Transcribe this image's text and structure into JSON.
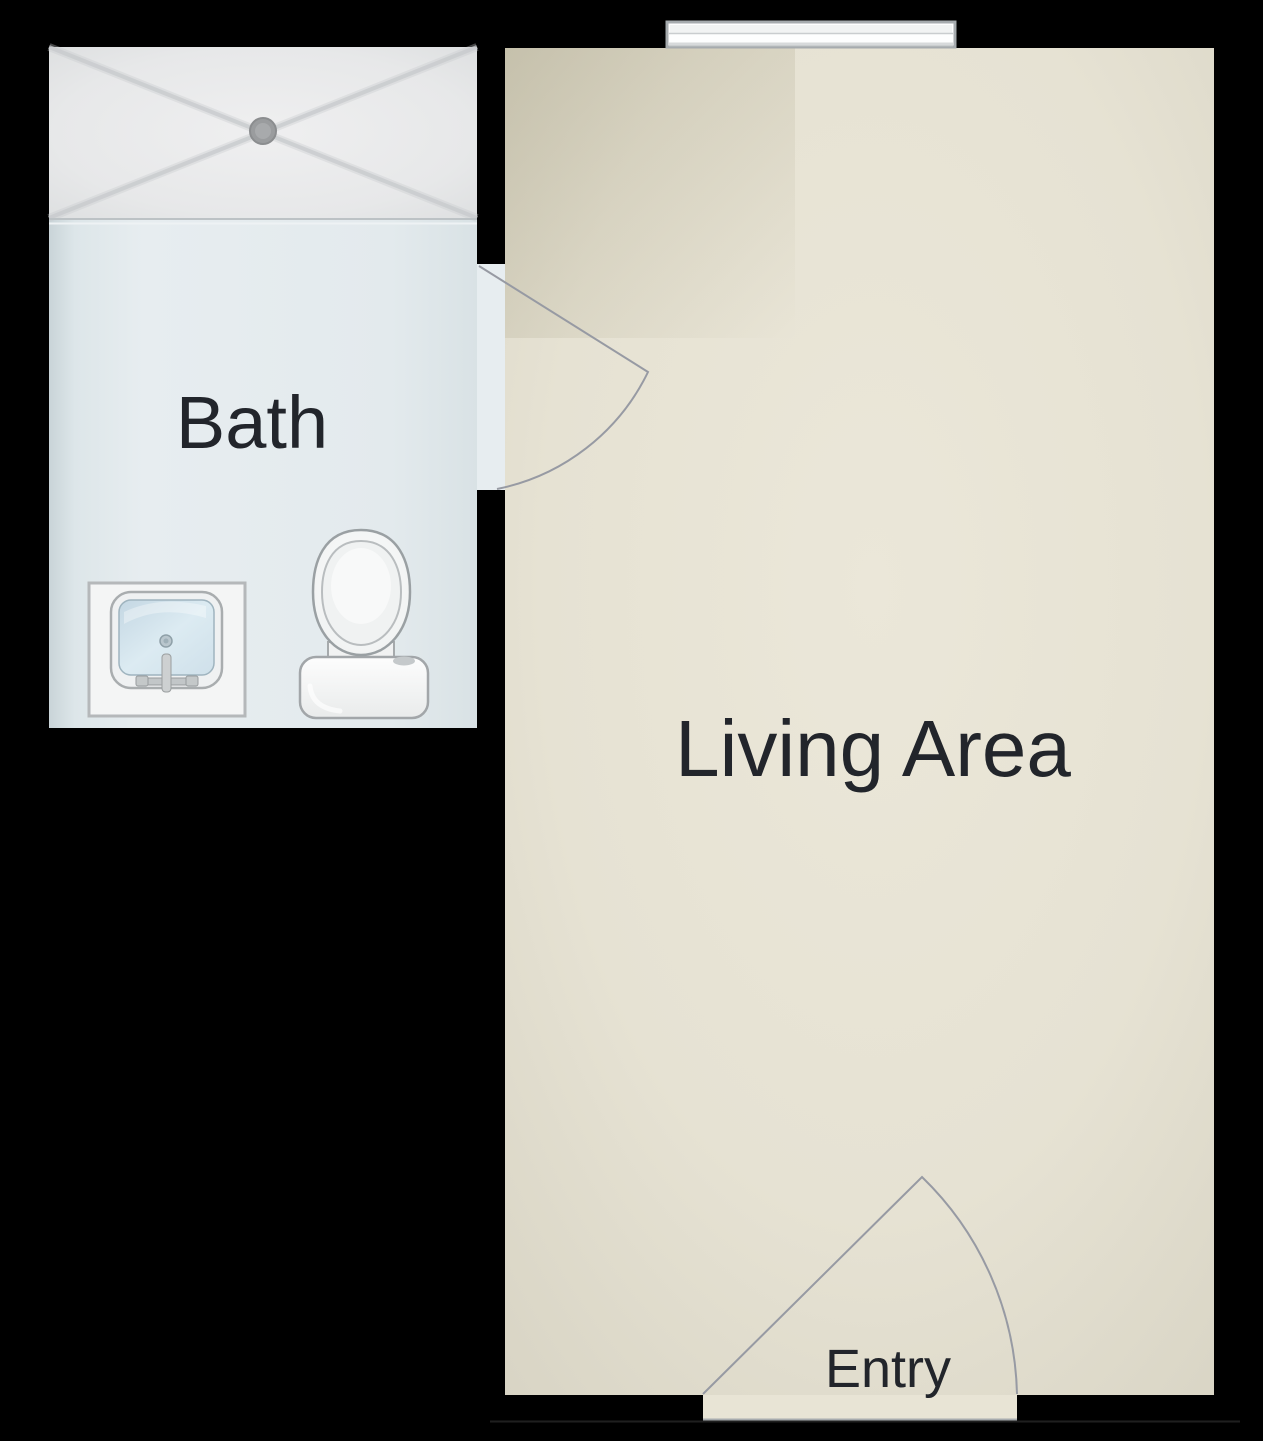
{
  "floorplan": {
    "rooms": [
      {
        "id": "bath",
        "label": "Bath"
      },
      {
        "id": "living",
        "label": "Living Area"
      },
      {
        "id": "entry",
        "label": "Entry"
      }
    ],
    "fixtures": [
      "shower-pan-icon",
      "shower-drain-icon",
      "sink-vanity-icon",
      "faucet-icon",
      "toilet-icon",
      "window-icon",
      "door-swing-icon",
      "entry-door-swing-icon"
    ],
    "colors": {
      "background": "#000000",
      "living_floor": "#e6e2d3",
      "bath_floor": "#e3eaed",
      "shower_pan": "#e9eaeb",
      "fixture_white": "#f7f8f8",
      "fixture_stroke": "#9da1a4",
      "door_line": "#979aa3",
      "window_frame": "#a6abae",
      "label_text": "#22252b"
    }
  }
}
